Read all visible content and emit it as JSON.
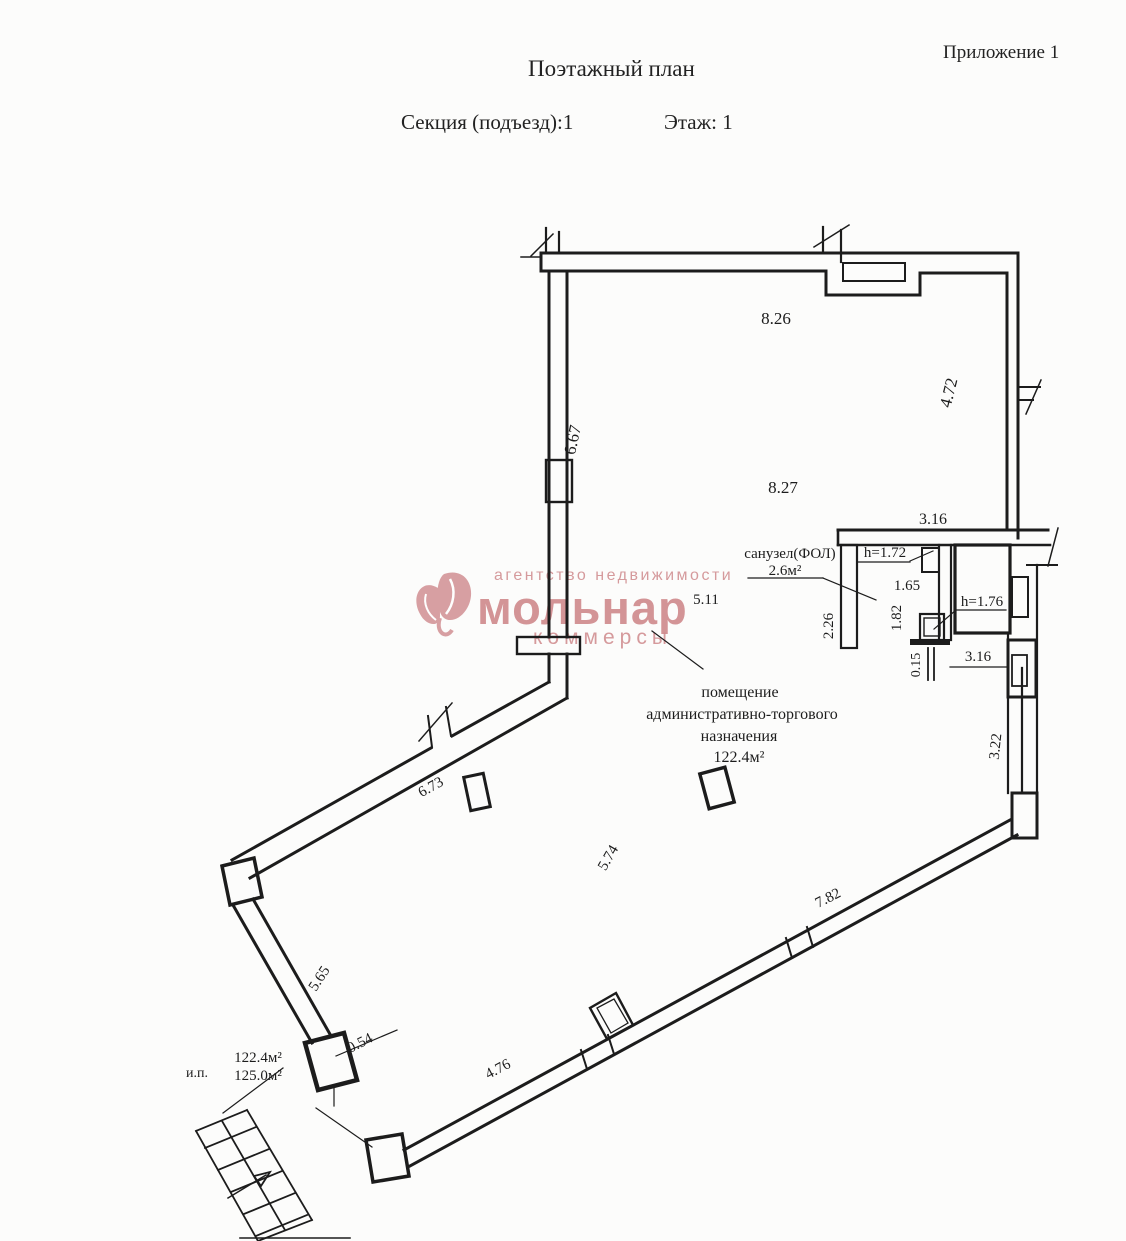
{
  "header": {
    "title": "Поэтажный план",
    "annex": "Приложение 1",
    "section": "Секция (подъезд):1",
    "floor": "Этаж: 1"
  },
  "watermark": {
    "tagline": "агентство недвижимости",
    "brand": "мольнар",
    "subbrand": "коммерсы",
    "color": "#cf898c"
  },
  "labels": {
    "room_line1": "помещение",
    "room_line2": "административно-торгового",
    "room_line3": "назначения",
    "room_area": "122.4м²",
    "san_name": "санузел(ФОЛ)",
    "san_area": "2.6м²",
    "ip": "и.п.",
    "ip_area1": "122.4м²",
    "ip_area2": "125.0м²"
  },
  "dims": {
    "top": "8.26",
    "right_top": "4.72",
    "left": "6.67",
    "mid": "8.27",
    "san_top": "3.16",
    "inner_width": "5.11",
    "san_left": "2.26",
    "san_h1": "h=1.72",
    "san_w1": "1.65",
    "san_w2": "1.82",
    "san_h2": "h=1.76",
    "san_gap": "0.15",
    "san_bottom": "3.16",
    "right_bottom": "3.22",
    "diag_left": "6.73",
    "room_depth": "5.74",
    "bottom_right": "7.82",
    "left_lower": "5.65",
    "door": "0.54",
    "bottom_left": "4.76"
  }
}
